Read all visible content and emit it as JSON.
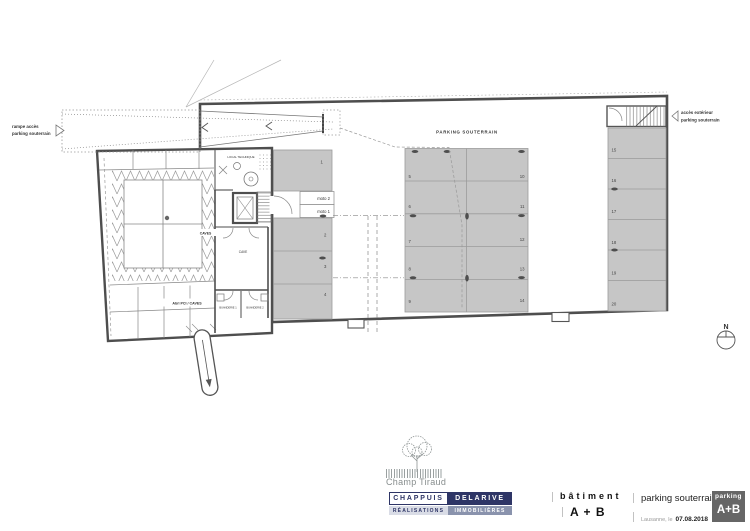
{
  "plan": {
    "area_title": "PARKING SOUTERRAIN",
    "ramp_label": {
      "l1": "rampe accès",
      "l2": "parking souterrain"
    },
    "ext_access": {
      "l1": "accès extérieur",
      "l2": "parking souterrain"
    },
    "compass_n": "N",
    "rooms": {
      "local_technique": "LOCAL TECHNIQUE",
      "caves": "CAVES",
      "cave": "CAVE",
      "abri": "Abri PCI / CAVES",
      "buanderie1": "BUANDERIE 1",
      "buanderie2": "BUANDERIE 2"
    },
    "stalls": {
      "s1": "1",
      "s2": "2",
      "s3": "3",
      "s4": "4",
      "s5": "5",
      "s6": "6",
      "s7": "7",
      "s8": "8",
      "s9": "9",
      "s10": "10",
      "s11": "11",
      "s12": "12",
      "s13": "13",
      "s14": "14",
      "s15": "15",
      "s16": "16",
      "s17": "17",
      "s18": "18",
      "s19": "19",
      "s20": "20",
      "moto1": "moto 1",
      "moto2": "moto 2"
    }
  },
  "title_block": {
    "brand_name": "Champ Tiraud",
    "company": {
      "c1": "CHAPPUIS",
      "c2": "DELARIVE",
      "c3": "RÉALISATIONS",
      "c4": "IMMOBILIÈRES"
    },
    "building_label": "bâtiment",
    "building_value": "A + B",
    "doc_title": "parking souterrain",
    "place_label": "Lausanne, le",
    "date": "07.08.2018",
    "badge_top": "parking",
    "badge_value": "A+B"
  },
  "colors": {
    "stall_fill": "#c6c6c6",
    "wall": "#4e4e4e",
    "navy": "#2e3566",
    "slate": "#8a93ad",
    "badge_gray": "#666666"
  }
}
